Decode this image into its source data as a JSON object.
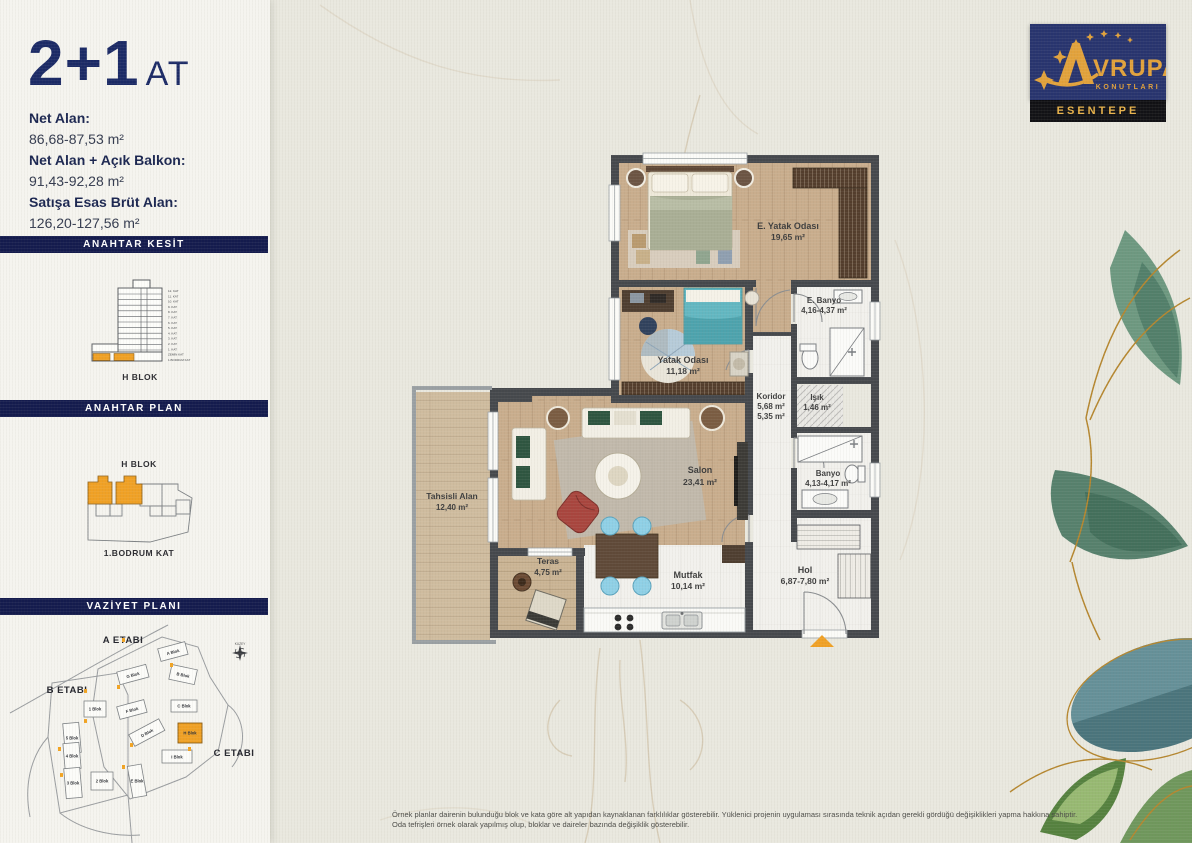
{
  "header": {
    "title": "2+1",
    "title_suffix": "AT"
  },
  "areas": [
    {
      "label": "Net Alan:",
      "value": "86,68-87,53 m²"
    },
    {
      "label": "Net Alan + Açık Balkon:",
      "value": "91,43-92,28 m²"
    },
    {
      "label": "Satışa Esas Brüt Alan:",
      "value": "126,20-127,56 m²"
    }
  ],
  "sidebar": {
    "kesit": {
      "title": "ANAHTAR KESİT",
      "block_label": "H BLOK",
      "floors": [
        "12. KAT",
        "11. KAT",
        "10. KAT",
        "9. KAT",
        "8. KAT",
        "7. KAT",
        "6. KAT",
        "5. KAT",
        "4. KAT",
        "3. KAT",
        "2. KAT",
        "1. KAT",
        "ZEMİN KAT",
        "1.BODRUM KAT"
      ]
    },
    "keyplan": {
      "title": "ANAHTAR PLAN",
      "block_label": "H BLOK",
      "floor_label": "1.BODRUM KAT"
    },
    "vaziyet": {
      "title": "VAZİYET PLANI",
      "etap_a": "A ETABI",
      "etap_b": "B ETABI",
      "etap_c": "C ETABI",
      "compass_label": "KUZEY",
      "blocks": {
        "a": "A Blok",
        "b": "B Blok",
        "c": "C Blok",
        "d": "D Blok",
        "e": "E Blok",
        "f": "F Blok",
        "g": "G Blok",
        "h": "H Blok",
        "i": "I Blok",
        "n1": "1 Blok",
        "n2": "2 Blok",
        "n3": "3 Blok",
        "n4": "4 Blok",
        "n5": "5 Blok"
      }
    }
  },
  "logo": {
    "brand": "VRUPA",
    "brand_sub": "KONUTLARI",
    "project": "ESENTEPE"
  },
  "rooms": {
    "eyatak": {
      "name": "E. Yatak Odası",
      "area": "19,65 m²"
    },
    "ebanyo": {
      "name": "E. Banyo",
      "area": "4,16-4,37 m²"
    },
    "yatak": {
      "name": "Yatak Odası",
      "area": "11,18 m²"
    },
    "koridor": {
      "name": "Koridor",
      "area": "5,68 m²",
      "area2": "5,35 m²"
    },
    "isik": {
      "name": "Işık",
      "area": "1,46 m²"
    },
    "banyo": {
      "name": "Banyo",
      "area": "4,13-4,17 m²"
    },
    "salon": {
      "name": "Salon",
      "area": "23,41 m²"
    },
    "tahsisli": {
      "name": "Tahsisli Alan",
      "area": "12,40 m²"
    },
    "teras": {
      "name": "Teras",
      "area": "4,75 m²"
    },
    "mutfak": {
      "name": "Mutfak",
      "area": "10,14 m²"
    },
    "hol": {
      "name": "Hol",
      "area": "6,87-7,80 m²"
    }
  },
  "footer": {
    "line1": "Örnek planlar dairenin bulunduğu blok ve kata göre alt yapıdan kaynaklanan farklılıklar gösterebilir. Yüklenici projenin uygulaması sırasında teknik açıdan gerekli gördüğü değişiklikleri yapma hakkına sahiptir.",
    "line2": "Oda tefrişleri örnek olarak yapılmış olup, bloklar ve daireler bazında değişiklik gösterebilir."
  },
  "colors": {
    "navy": "#141b4d",
    "title_navy": "#1b2a66",
    "accent_orange": "#f0a125",
    "logo_gold": "#e2a23b",
    "wall_gray": "#45484c",
    "wood": "#c9ad8d",
    "paper": "#e9e8df"
  }
}
